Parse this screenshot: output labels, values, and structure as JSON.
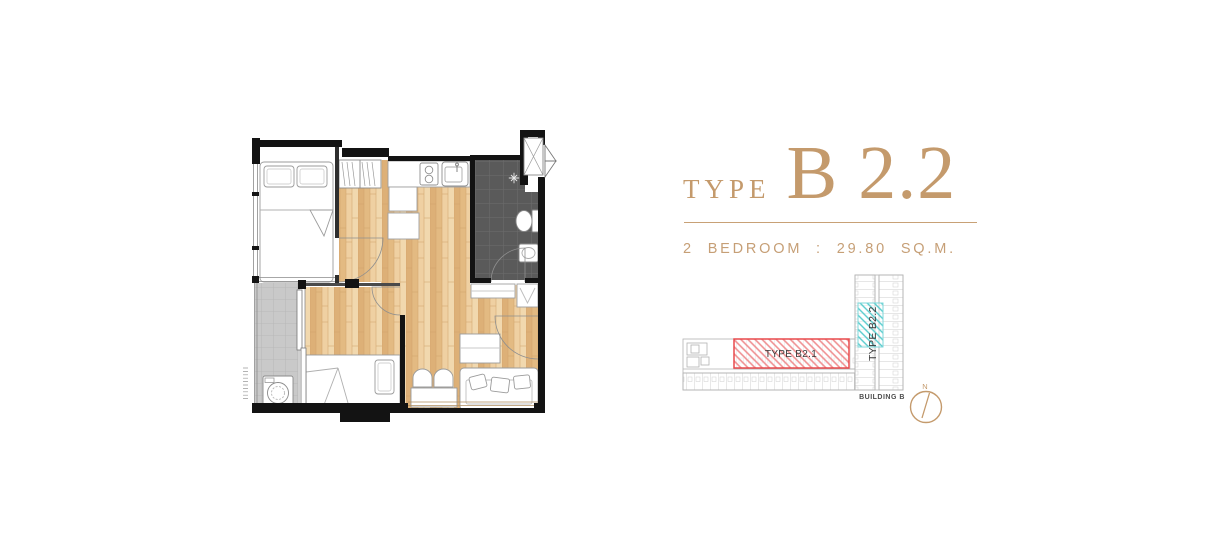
{
  "header": {
    "type_label": "TYPE",
    "unit_name": "B 2.2",
    "spec_line": "2 BEDROOM : 29.80 SQ.M."
  },
  "site_plan": {
    "unit_b21_label": "TYPE B2.1",
    "unit_b22_label": "TYPE B2.2",
    "building_label": "BUILDING B",
    "compass_north_label": "N"
  },
  "colors": {
    "accent_gold": "#c49a6c",
    "highlight_red": "#e84a4d",
    "highlight_cyan": "#45c6c9",
    "wood_floor": "#e7c28d",
    "bathroom_tile": "#5a5a5a",
    "balcony_tile": "#c9c9c9",
    "wall": "#131313"
  },
  "floor_plan": {
    "features": [
      "double-bed",
      "wardrobe",
      "kitchen-counter",
      "stove",
      "sink",
      "bathroom",
      "toilet",
      "basin",
      "entry-door",
      "balcony",
      "washing-machine",
      "single-bed",
      "dining-chairs",
      "dining-table",
      "sofa",
      "tv-cabinet",
      "sliding-door"
    ]
  }
}
